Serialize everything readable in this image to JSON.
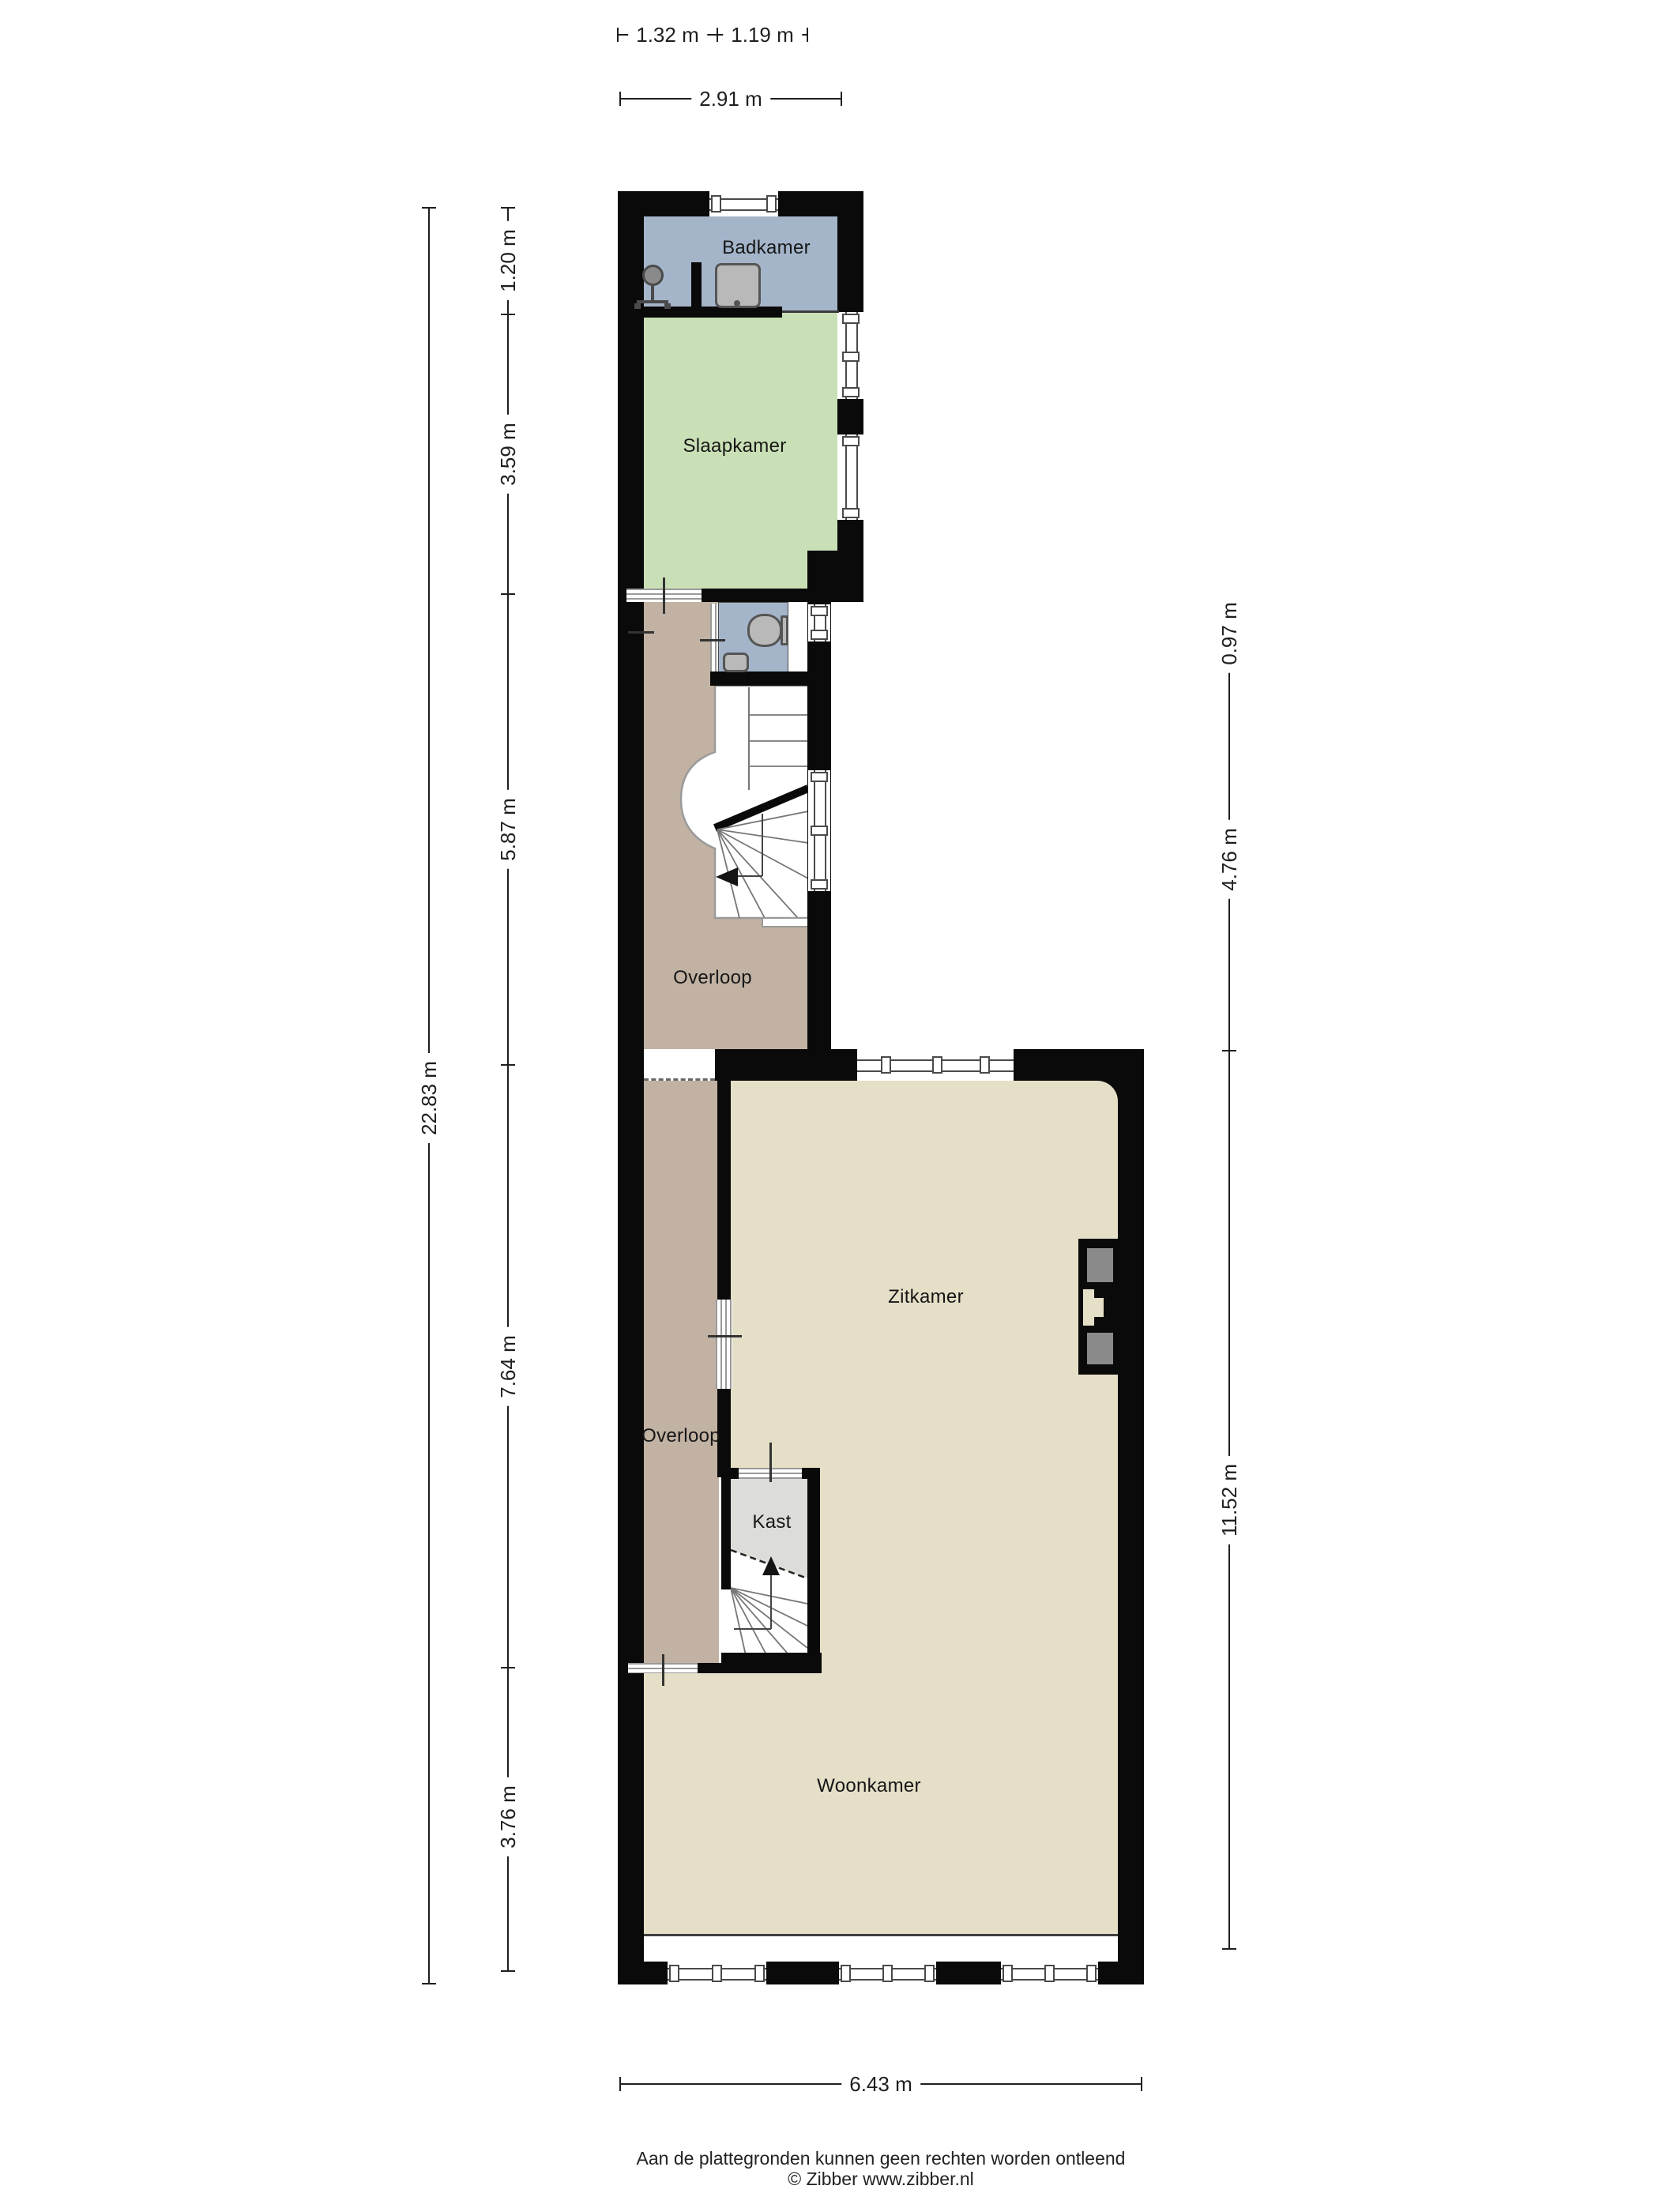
{
  "title": "Floor plan (plattegrond)",
  "colors": {
    "wall": "#0a0a0a",
    "bathroom_floor": "#a4b5ca",
    "bedroom_floor": "#c9dfb5",
    "landing_floor": "#c1b2a3",
    "living_floor": "#e5dfc8",
    "closet_floor": "#dcdcd8",
    "fixture_fill": "#b9b9b9",
    "fixture_stroke": "#555555",
    "chimney_block": "#8a8a8a",
    "dim_color": "#1f1f1f"
  },
  "rooms": {
    "badkamer": {
      "label": "Badkamer"
    },
    "slaapkamer": {
      "label": "Slaapkamer"
    },
    "overloop_boven": {
      "label": "Overloop"
    },
    "zitkamer": {
      "label": "Zitkamer"
    },
    "kast": {
      "label": "Kast"
    },
    "overloop_beneden": {
      "label": "Overloop"
    },
    "woonkamer": {
      "label": "Woonkamer"
    }
  },
  "dims": {
    "top": [
      {
        "label": "1.32 m"
      },
      {
        "label": "1.19 m"
      },
      {
        "label": "2.91 m"
      }
    ],
    "left": [
      {
        "label": "1.20 m"
      },
      {
        "label": "3.59 m"
      },
      {
        "label": "5.87 m"
      },
      {
        "label": "7.64 m"
      },
      {
        "label": "3.76 m"
      }
    ],
    "left_total": {
      "label": "22.83 m"
    },
    "right": [
      {
        "label": "0.97 m"
      },
      {
        "label": "4.76 m"
      },
      {
        "label": "11.52 m"
      }
    ],
    "bottom": {
      "label": "6.43 m"
    }
  },
  "icons": {
    "shower": "shower-icon",
    "bath_sink": "sink-icon",
    "toilet": "toilet-icon",
    "wc_sink": "sink-icon",
    "fireplace": "fireplace-icon",
    "stairs_up_arrow": "arrow-up-icon",
    "stairs_down_arrow": "arrow-left-icon"
  },
  "footer": {
    "disclaimer": "Aan de plattegronden kunnen geen rechten worden ontleend",
    "credit": "© Zibber www.zibber.nl"
  }
}
